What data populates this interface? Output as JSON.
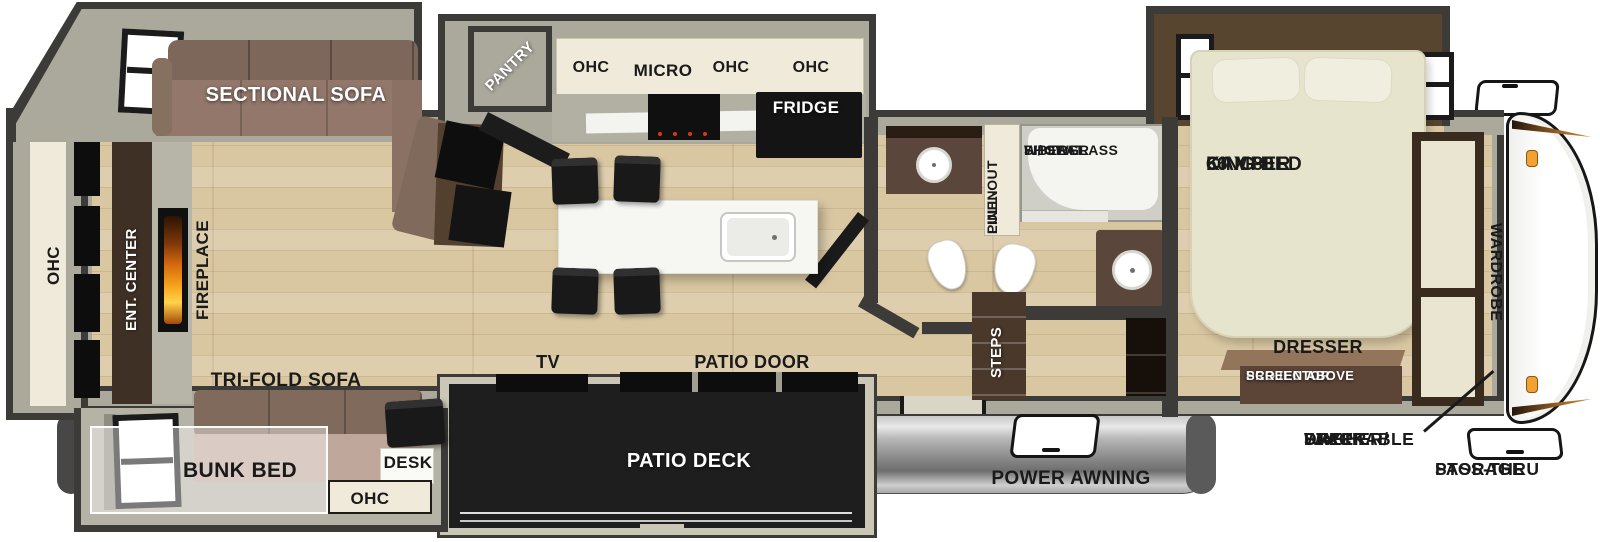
{
  "colors": {
    "wall_dark": "#3c3b38",
    "wall_fill": "#aba89c",
    "floor_wood": "#d9c7a2",
    "cream": "#efead9",
    "sofa_brown": "#8a7164",
    "cabinet_brown": "#5a463a",
    "bed_cream": "#e7e4cd",
    "appliance_black": "#141414",
    "awning_gray": "#a9a9a9",
    "deck_dark": "#1e1e1e",
    "accent_orange": "#f2a233",
    "label_black": "#1a1a1a",
    "label_white": "#ffffff"
  },
  "labels": {
    "rear": {
      "ohc": "OHC",
      "ent_center": "ENT. CENTER",
      "fireplace": "FIREPLACE"
    },
    "living": {
      "sectional_sofa": "SECTIONAL SOFA",
      "tri_fold_sofa": "TRI-FOLD SOFA",
      "bunk_bed": "BUNK BED",
      "desk": "DESK",
      "desk_ohc": "OHC",
      "tv": "TV",
      "patio_door": "PATIO DOOR"
    },
    "kitchen": {
      "pantry": "PANTRY",
      "ohc_left": "OHC",
      "micro": "MICRO",
      "ohc_mid": "OHC",
      "ohc_right": "OHC",
      "fridge": "FRIDGE"
    },
    "bath": {
      "pull_out_linen": [
        "PULL-OUT",
        "LINEN"
      ],
      "shower": [
        "FIBERGLASS",
        "SHOWER",
        "W/ SEAT"
      ],
      "steps": "STEPS"
    },
    "bedroom": {
      "king_bed": [
        "66 X 80",
        "CAMPER",
        "KING BED"
      ],
      "dresser": "DRESSER",
      "projector": [
        "PROJECTOR",
        "SCREEN ABOVE"
      ],
      "wardrobe": "WARDROBE"
    },
    "exterior": {
      "patio_deck": "PATIO DECK",
      "power_awning": "POWER AWNING",
      "pass_thru": [
        "PASS-THRU",
        "STORAGE"
      ],
      "stackable": [
        "STACKABLE",
        "WASHER/",
        "DRYER",
        "PREP"
      ]
    }
  }
}
